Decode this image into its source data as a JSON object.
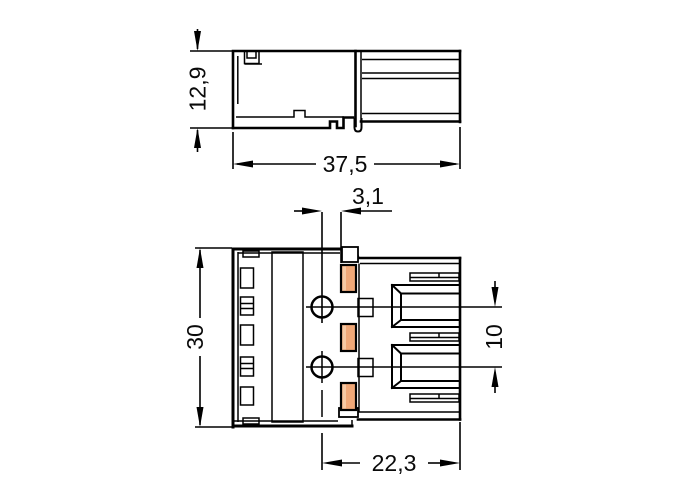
{
  "drawing": {
    "type": "technical-dimensional-drawing",
    "subject": "3-pole plug connector",
    "background_color": "#ffffff",
    "line_color": "#000000",
    "contact_color": "#f0a878",
    "contact_highlight_color": "#f6c9a4",
    "views": {
      "side": {
        "name": "side-view",
        "dims": {
          "height": "12,9",
          "width": "37,5"
        }
      },
      "front": {
        "name": "front-view",
        "poles": 3,
        "dims": {
          "offset": "3,1",
          "height": "30",
          "pitch": "10",
          "depth": "22,3"
        }
      }
    }
  }
}
